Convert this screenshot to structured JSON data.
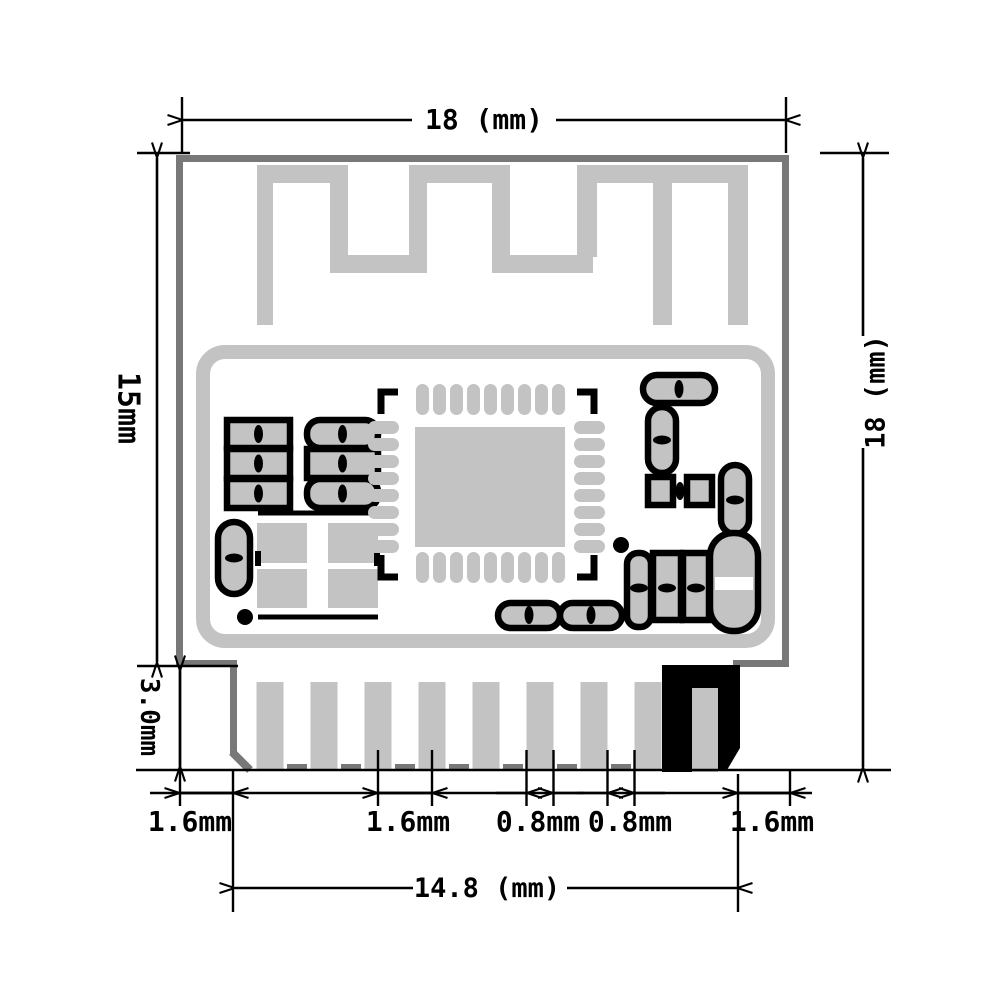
{
  "drawing": {
    "type": "pcb-module-dimension-diagram",
    "gnd_pin_label": "GND",
    "colors": {
      "background": "#ffffff",
      "copper_silver": "#c3c3c3",
      "board_edge_gray": "#787878",
      "dimension_black": "#000000",
      "gnd_pad_fill": "#000000",
      "gnd_pad_text": "#ffffff"
    },
    "dimensions": {
      "top_width": "18 (mm)",
      "left_height": "15mm",
      "left_lower_height": "3.0mm",
      "right_height": "18 (mm)",
      "bottom_width": "14.8 (mm)",
      "bottom_margin_left": "1.6mm",
      "bottom_pin_pitch": "1.6mm",
      "bottom_pin_width": "0.8mm",
      "bottom_pin_gap": "0.8mm",
      "bottom_margin_right": "1.6mm"
    },
    "counts": {
      "bottom_pins": 9,
      "qfn_pads_top": 9,
      "qfn_pads_bottom": 9,
      "qfn_pads_left": 8,
      "qfn_pads_right": 8
    }
  }
}
